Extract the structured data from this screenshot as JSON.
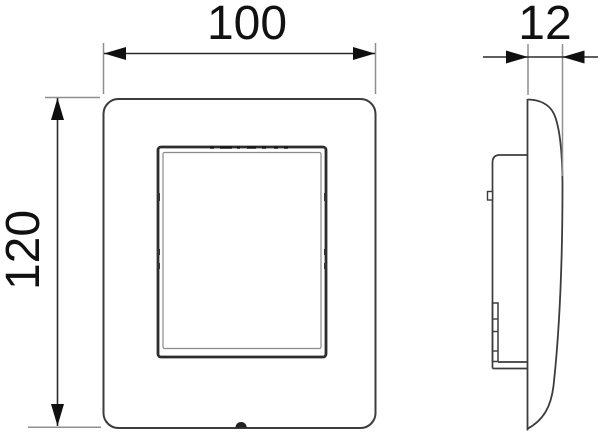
{
  "drawing": {
    "type": "technical-dimension-drawing",
    "subject": "wall-flush-plate-front-and-side-views",
    "background": "#ffffff",
    "colors": {
      "outline": "#3c3c3c",
      "button_frame": "#2d2d2d",
      "inner_seam": "#8a8a8a",
      "dimension_line": "#2a2a2a",
      "extension_line": "#8f8f8f",
      "arrow": "#101010",
      "label_text": "#111111"
    },
    "views": {
      "front": {
        "name": "front-view"
      },
      "side": {
        "name": "side-profile-view"
      }
    },
    "dimensions": {
      "width": {
        "value": "100",
        "view": "front",
        "orientation": "horizontal"
      },
      "height": {
        "value": "120",
        "view": "front",
        "orientation": "vertical"
      },
      "depth": {
        "value": "12",
        "view": "side",
        "orientation": "horizontal"
      }
    }
  }
}
